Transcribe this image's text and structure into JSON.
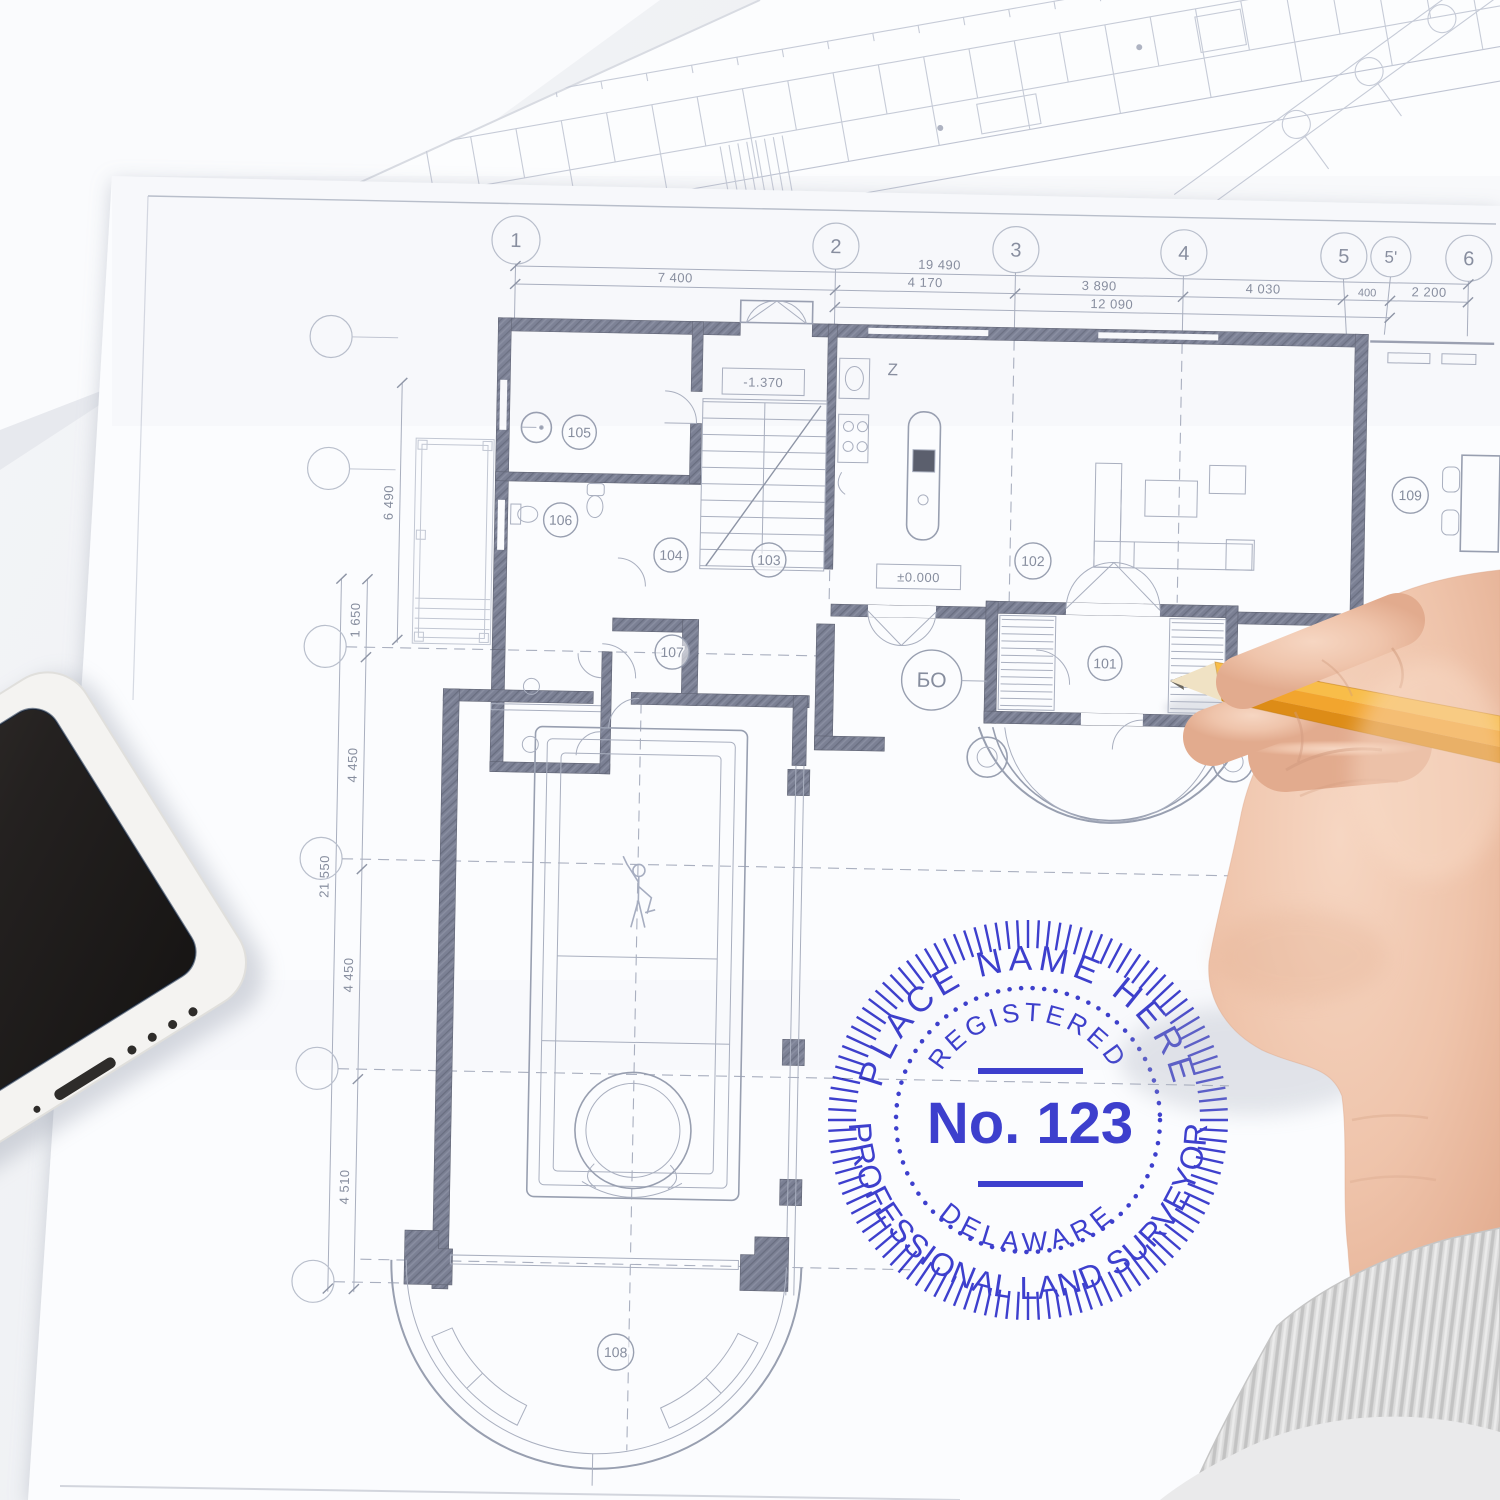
{
  "stamp": {
    "arc_top_outer": "PLACE NAME HERE",
    "arc_top_inner": "REGISTERED",
    "number": "No. 123",
    "arc_bottom_inner": "DELAWARE",
    "arc_bottom_outer": "PROFESSIONAL LAND SURVEYOR",
    "ink_color": "#2f31cb"
  },
  "blueprint": {
    "grid_bubbles": [
      "1",
      "2",
      "3",
      "4",
      "5",
      "5'",
      "6"
    ],
    "dim_overall_top": "19 490",
    "dim_row_top": [
      "7 400",
      "4 170",
      "3 890",
      "4 030",
      "400",
      "2 200"
    ],
    "dim_sub_top": "12 090",
    "dim_overall_left": "21 550",
    "dim_segments_left": [
      "1 650",
      "4 450",
      "4 450",
      "4 510"
    ],
    "dim_inner_left": "6 490",
    "room_numbers": [
      "101",
      "102",
      "103",
      "104",
      "105",
      "106",
      "107",
      "108",
      "109"
    ],
    "section_bubble": "БО",
    "level_low": "-1.370",
    "level_zero": "±0.000",
    "kitchen_mark": "Z"
  }
}
